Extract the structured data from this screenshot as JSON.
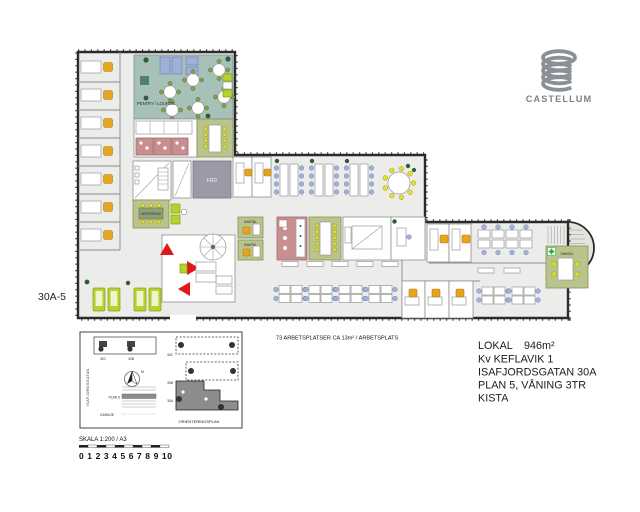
{
  "document": {
    "plan_code": "30A-5",
    "workspaces_note": "73 ARBETSPLATSER CA 13m² / ARBETSPLATS",
    "info": {
      "lokal_label": "LOKAL",
      "area": "946m²",
      "block": "Kv KEFLAVIK 1",
      "address": "ISAFJORDSGATAN 30A",
      "floor": "PLAN 5, VÅNING 3TR",
      "city": "KISTA"
    }
  },
  "branding": {
    "name": "CASTELLUM"
  },
  "rooms": {
    "pentry_lounge": "PENTRY / LOUNGE",
    "motesrum": "MÖTESRUM",
    "frd": "FRD",
    "samtal": "SAMTAL"
  },
  "orientation": {
    "street": "ISAFJORDSGATAN",
    "buildings": {
      "b32c": "32C",
      "b32b": "32B",
      "b30c": "30C",
      "b30b": "30B",
      "b30a": "30A"
    },
    "plan5": "PLAN 5",
    "garage": "GARAGE",
    "north": "N",
    "title": "ORIENTERINGSPLAN"
  },
  "scale": {
    "label": "SKALA 1:200 / A3",
    "numbers": "0 1 2 3 4 5 6 7 8 9 10"
  },
  "colors": {
    "lounge_teal": "#a7c0b8",
    "meeting_green": "#b9c38c",
    "kitchen_pink": "#c88f90",
    "storage_gray": "#9b9ba8",
    "chair_orange": "#e7a51f",
    "chair_blue": "#a3b1d6",
    "chair_lime": "#b5d22e",
    "arrow_red": "#e01818",
    "wall_dark": "#2b2b2b",
    "floor_gray": "#ececea",
    "logo_gray": "#8a9096"
  }
}
